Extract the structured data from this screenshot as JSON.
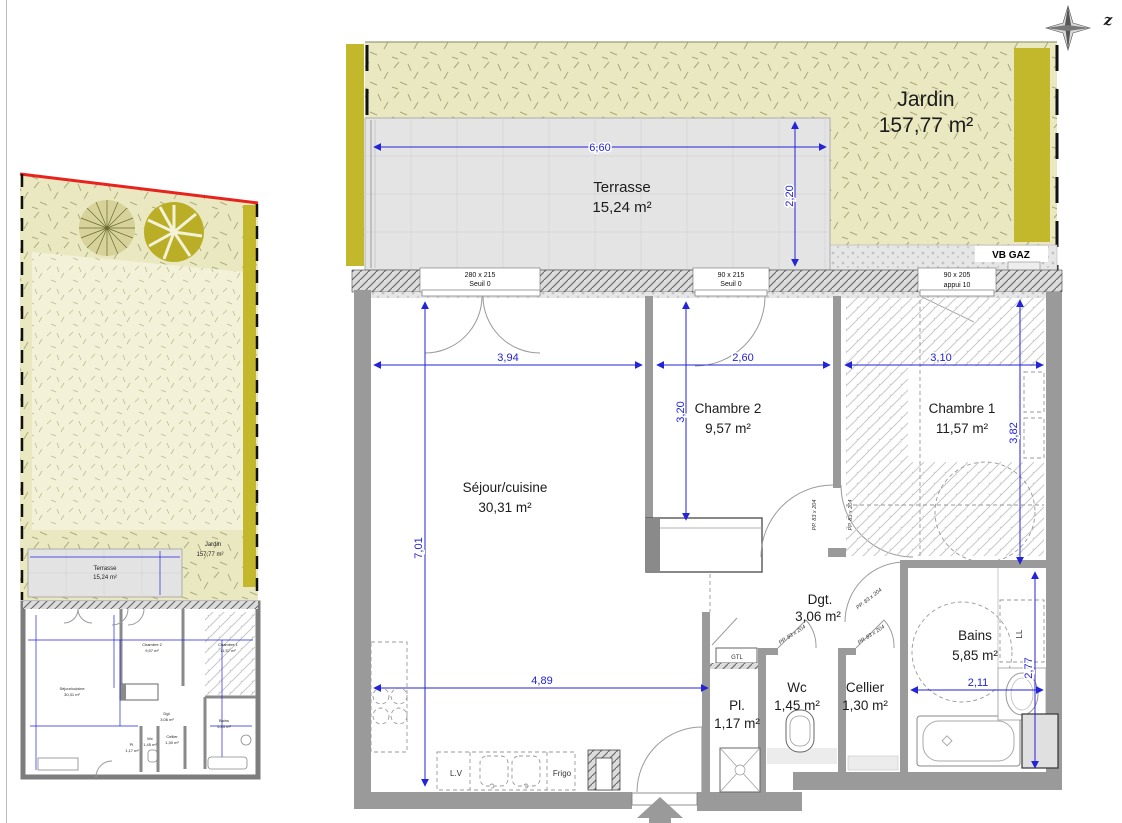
{
  "page": {
    "compass_label": "z"
  },
  "outdoor": {
    "jardin_name": "Jardin",
    "jardin_area": "157,77 m²",
    "terrasse_name": "Terrasse",
    "terrasse_area": "15,24 m²",
    "vb_gaz": "VB GAZ"
  },
  "rooms": {
    "sejour": {
      "name": "Séjour/cuisine",
      "area": "30,31 m²"
    },
    "chambre2": {
      "name": "Chambre 2",
      "area": "9,57 m²"
    },
    "chambre1": {
      "name": "Chambre 1",
      "area": "11,57 m²"
    },
    "dgt": {
      "name": "Dgt.",
      "area": "3,06 m²"
    },
    "bains": {
      "name": "Bains",
      "area": "5,85 m²"
    },
    "pl": {
      "name": "Pl.",
      "area": "1,17 m²"
    },
    "wc": {
      "name": "Wc",
      "area": "1,45 m²"
    },
    "cellier": {
      "name": "Cellier",
      "area": "1,30 m²"
    }
  },
  "dims": {
    "terrasse_w": "6,60",
    "terrasse_d": "2,20",
    "sejour_w": "3,94",
    "ch2_w": "2,60",
    "ch1_w": "3,10",
    "ch2_h": "3,20",
    "ch1_h": "3,82",
    "sejour_h": "7,01",
    "sejour_bottom": "4,89",
    "bains_w": "2,11",
    "bains_h": "2,77"
  },
  "openings": {
    "w1_size": "280 x 215",
    "w1_note": "Seuil 0",
    "w2_size": "90 x 215",
    "w2_note": "Seuil 0",
    "w3_size": "90 x 205",
    "w3_note": "appui 10",
    "door": "PP. 83 x 204"
  },
  "equip": {
    "gtl": "GTL",
    "lv": "L.V",
    "frigo": "Frigo",
    "ll": "LL"
  },
  "colors": {
    "dimension_blue": "#2323d8",
    "grass": "#eae8c0",
    "hedge": "#c3b72c",
    "terrace_grey": "#e4e4e4",
    "wall_grey": "#9a9a9a",
    "boundary_red": "#e8221c"
  }
}
